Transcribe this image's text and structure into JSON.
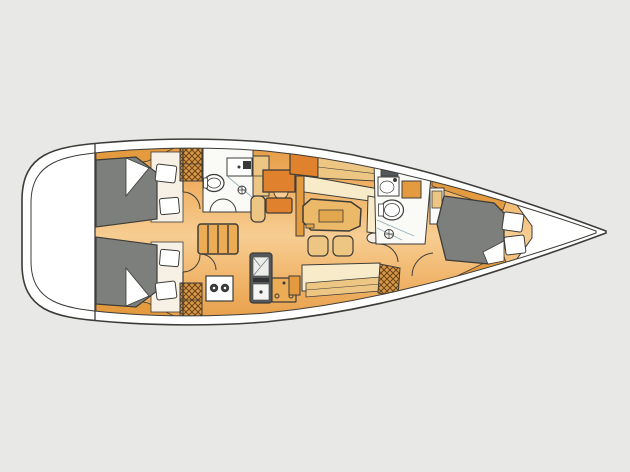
{
  "diagram": {
    "type": "floor-plan",
    "subject": "sailing-yacht-interior-layout-top-view",
    "orientation": {
      "bow": "right",
      "stern": "left"
    },
    "canvas": {
      "width": 630,
      "height": 472
    }
  },
  "colors": {
    "bg": "#e8e8e7",
    "line": "#3d3c38",
    "line-soft": "#8a8a85",
    "hull-white": "#ffffff",
    "room-white": "#fafaf7",
    "off-white": "#f6f1e4",
    "floor-edge": "#e3973f",
    "floor-mid": "#efb164",
    "floor-light": "#f7cd92",
    "wood-dark": "#e49a3f",
    "wood-mid": "#ecab55",
    "wood-tan": "#eec684",
    "table-tan": "#ebb968",
    "table-inner": "#e2a64e",
    "accent-orange": "#e0812d",
    "cream": "#f7ebc9",
    "berth-gray": "#7d7f7d",
    "appliance-dark": "#54585a",
    "fixture-dark": "#3a3a3a",
    "hatch-bg": "#d9994a",
    "hatch-line": "#6b4316",
    "glass-line": "#9ab0b8"
  },
  "regions": [
    {
      "name": "stern-platform"
    },
    {
      "name": "aft-cabin-top",
      "features": [
        "double-berth",
        "pillows",
        "hanging-locker",
        "door"
      ]
    },
    {
      "name": "aft-cabin-bottom",
      "features": [
        "double-berth",
        "pillows",
        "hanging-locker",
        "door"
      ]
    },
    {
      "name": "aft-head",
      "features": [
        "toilet",
        "sink-counter",
        "shower-drain",
        "double-doors"
      ]
    },
    {
      "name": "companionway-stairs",
      "features": [
        "four-steps"
      ]
    },
    {
      "name": "galley",
      "features": [
        "two-burner-stove",
        "oven-sink-unit",
        "icebox"
      ]
    },
    {
      "name": "nav-station",
      "features": [
        "chart-table",
        "seat",
        "cabinet"
      ]
    },
    {
      "name": "saloon",
      "features": [
        "l-settee",
        "octagonal-table",
        "two-stools",
        "long-settee",
        "sideboard",
        "hanging-locker"
      ]
    },
    {
      "name": "forward-head",
      "features": [
        "toilet",
        "sink",
        "vanity",
        "shower-drain",
        "door"
      ]
    },
    {
      "name": "forward-cabin",
      "features": [
        "v-berth",
        "pillows",
        "bench-seat",
        "hull-shelves"
      ]
    },
    {
      "name": "anchor-locker-bow"
    }
  ]
}
